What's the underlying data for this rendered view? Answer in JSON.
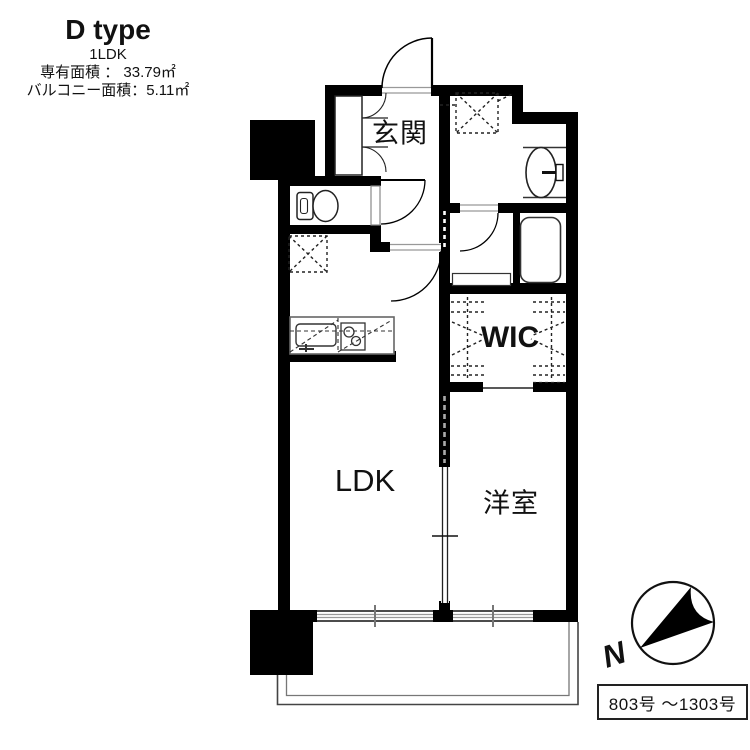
{
  "title_block": {
    "type_name": "D type",
    "layout": "1LDK",
    "exclusive_area": "専有面積 ： 33.79㎡",
    "balcony_area": "バルコニー面積：5.11㎡"
  },
  "rooms": {
    "entrance": "玄関",
    "wic": "WIC",
    "ldk": "LDK",
    "western_room": "洋室"
  },
  "compass": {
    "north_label": "N",
    "direction": "north-pointing-lower-left"
  },
  "unit_range_label": "803号 ～1303号",
  "colors": {
    "wall": "#000000",
    "line": "#333333",
    "muted_line": "#999999",
    "background": "#ffffff"
  },
  "icons": [
    "entrance-door-icon",
    "shoe-cabinet-icon",
    "toilet-icon",
    "refrigerator-space-icon",
    "kitchen-counter-icon",
    "kitchen-sink-icon",
    "stove-icon",
    "washer-space-icon",
    "washbasin-icon",
    "bathtub-icon",
    "hanger-pipe-icon",
    "pocket-door-icon",
    "sliding-door-icon",
    "window-icon",
    "balcony-outline",
    "compass-icon"
  ]
}
